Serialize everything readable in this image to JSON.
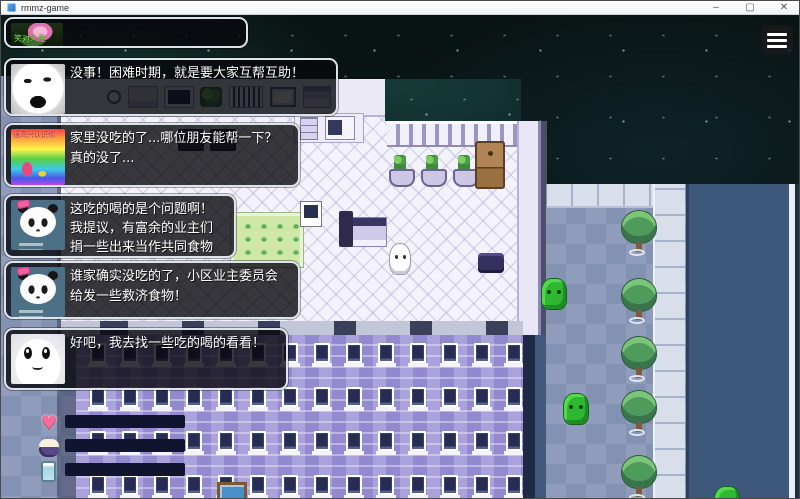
{
  "window": {
    "title": "rmmz-game",
    "minimize": "–",
    "maximize": "▢",
    "close": "✕"
  },
  "chat": {
    "messages": [
      {
        "avatar": "lotus-photo",
        "caption": "笑对人生",
        "lines": []
      },
      {
        "avatar": "laughing-meme-face",
        "lines": [
          "没事！困难时期，就是要大家互帮互助！"
        ]
      },
      {
        "avatar": "rainbow-flower-greeting",
        "caption": "很高兴认识你",
        "lines": [
          "家里没吃的了...哪位朋友能帮一下？",
          "真的没了..."
        ]
      },
      {
        "avatar": "panda-meme-bow",
        "lines": [
          "这吃的喝的是个问题啊！",
          "我提议，有富余的业主们",
          "捐一些出来当作共同食物"
        ]
      },
      {
        "avatar": "panda-meme-bow",
        "lines": [
          "谁家确实没吃的了，小区业主委员会",
          "给发一些救济食物！"
        ]
      },
      {
        "avatar": "white-blob-smile",
        "lines": [
          "好吧，我去找一些吃的喝的看看！"
        ]
      }
    ]
  },
  "hud": {
    "bars": [
      {
        "icon": "heart",
        "percent": 100
      },
      {
        "icon": "rice-bowl",
        "percent": 79
      },
      {
        "icon": "water-glass",
        "percent": 69
      }
    ],
    "fill_color": "#13b04b",
    "track_color": "#10142e"
  },
  "map": {
    "facade_windows": {
      "cols": 14,
      "rows": 4,
      "step": 32
    },
    "trees": [
      {
        "x": 621,
        "y": 196
      },
      {
        "x": 621,
        "y": 264
      },
      {
        "x": 621,
        "y": 322
      },
      {
        "x": 621,
        "y": 376
      },
      {
        "x": 621,
        "y": 441
      }
    ],
    "npcs": [
      {
        "x": 541,
        "y": 264
      },
      {
        "x": 563,
        "y": 379
      },
      {
        "x": 714,
        "y": 472
      }
    ]
  }
}
